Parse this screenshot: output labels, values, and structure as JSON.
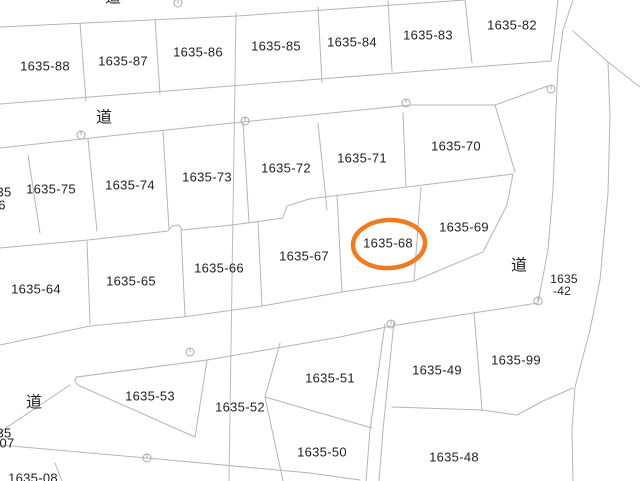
{
  "map": {
    "background": "#ffffff",
    "boundary_color": "#b5b5b5",
    "label_color": "#1f1f1f",
    "highlight": {
      "shape": "ellipse",
      "target_parcel": "1635-68",
      "color": "#ee7b22",
      "stroke_width": 4.5,
      "cx": 389,
      "cy": 244,
      "rx": 36,
      "ry": 24
    },
    "parcel_labels": [
      {
        "text": "1635-88",
        "x": 45,
        "y": 66,
        "size": 13
      },
      {
        "text": "1635-87",
        "x": 123,
        "y": 61,
        "size": 13
      },
      {
        "text": "1635-86",
        "x": 198,
        "y": 52,
        "size": 13
      },
      {
        "text": "1635-85",
        "x": 276,
        "y": 46,
        "size": 13
      },
      {
        "text": "1635-84",
        "x": 352,
        "y": 42,
        "size": 13
      },
      {
        "text": "1635-83",
        "x": 428,
        "y": 35,
        "size": 13
      },
      {
        "text": "1635-82",
        "x": 512,
        "y": 25,
        "size": 13
      },
      {
        "text": "1635-75",
        "x": 51,
        "y": 189,
        "size": 13
      },
      {
        "text": "1635-74",
        "x": 130,
        "y": 185,
        "size": 13
      },
      {
        "text": "1635-73",
        "x": 207,
        "y": 177,
        "size": 13
      },
      {
        "text": "1635-72",
        "x": 286,
        "y": 168,
        "size": 13
      },
      {
        "text": "1635-71",
        "x": 362,
        "y": 158,
        "size": 13
      },
      {
        "text": "1635-70",
        "x": 456,
        "y": 146,
        "size": 13
      },
      {
        "text": "1635-64",
        "x": 36,
        "y": 289,
        "size": 13
      },
      {
        "text": "1635-65",
        "x": 131,
        "y": 281,
        "size": 13
      },
      {
        "text": "1635-66",
        "x": 219,
        "y": 268,
        "size": 13
      },
      {
        "text": "1635-67",
        "x": 304,
        "y": 256,
        "size": 13
      },
      {
        "text": "1635-68",
        "x": 388,
        "y": 243,
        "size": 13
      },
      {
        "text": "1635-69",
        "x": 464,
        "y": 227,
        "size": 13
      },
      {
        "text": "1635-53",
        "x": 150,
        "y": 396,
        "size": 13
      },
      {
        "text": "1635-52",
        "x": 240,
        "y": 407,
        "size": 13
      },
      {
        "text": "1635-51",
        "x": 330,
        "y": 378,
        "size": 13
      },
      {
        "text": "1635-50",
        "x": 322,
        "y": 452,
        "size": 13
      },
      {
        "text": "1635-49",
        "x": 437,
        "y": 370,
        "size": 13
      },
      {
        "text": "1635-99",
        "x": 516,
        "y": 360,
        "size": 13
      },
      {
        "text": "1635-48",
        "x": 454,
        "y": 457,
        "size": 13
      },
      {
        "text": "1635",
        "x": 564,
        "y": 279,
        "size": 12
      },
      {
        "text": "-42",
        "x": 562,
        "y": 291,
        "size": 12
      }
    ],
    "road_labels": [
      {
        "text": "道",
        "x": 113,
        "y": -2
      },
      {
        "text": "道",
        "x": 104,
        "y": 118
      },
      {
        "text": "道",
        "x": 519,
        "y": 266
      },
      {
        "text": "道",
        "x": 34,
        "y": 403
      }
    ],
    "fragment_labels": [
      {
        "text": "35",
        "x": 4,
        "y": 192
      },
      {
        "text": "6",
        "x": 2,
        "y": 205
      },
      {
        "text": "35",
        "x": 4,
        "y": 433
      },
      {
        "text": "07",
        "x": 7,
        "y": 443
      },
      {
        "text": "1635-08",
        "x": 33,
        "y": 478
      }
    ],
    "survey_markers": [
      {
        "x": 178,
        "y": 3
      },
      {
        "x": 551,
        "y": 89
      },
      {
        "x": 406,
        "y": 103
      },
      {
        "x": 245,
        "y": 121
      },
      {
        "x": 81,
        "y": 135
      },
      {
        "x": 538,
        "y": 301
      },
      {
        "x": 391,
        "y": 324
      },
      {
        "x": 190,
        "y": 352
      },
      {
        "x": 147,
        "y": 458
      }
    ]
  }
}
